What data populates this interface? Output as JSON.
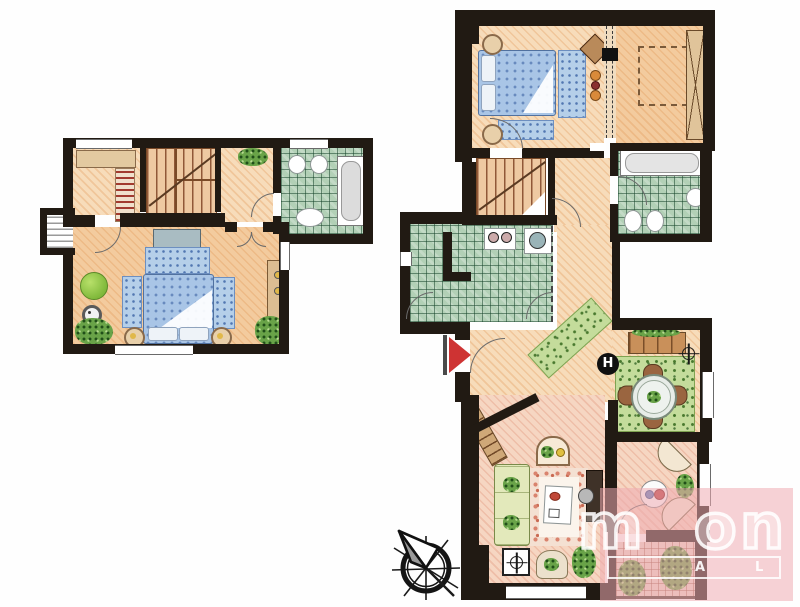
{
  "palette": {
    "wall_ink": "#211a13",
    "floor_peach": "#f7dcba",
    "floor_warm": "#f3cb9e",
    "floor_rose": "#f6d6c2",
    "tile_green": "#b2d0b6",
    "tile_green_line": "#1f4a30",
    "balcony_tile": "#ecd4c8",
    "bed_blue": "#a9c5e6",
    "rug_blue": "#b5cfe9",
    "rug_green": "#c4dc9b",
    "plant_green": "#69a348",
    "furniture_tan": "#e0c49a",
    "wood_brown": "#9a6540",
    "fixture_white": "#ffffff",
    "entrance_red": "#ce3333",
    "watermark_pink": "#eeacb2",
    "ink": "#1a1a1a"
  },
  "symbols": {
    "h_marker": "H"
  },
  "watermark": {
    "letters": [
      "m",
      "o",
      "n"
    ],
    "bar_letters": [
      "A",
      "L"
    ]
  },
  "icons": [
    "compass-rose-icon",
    "entrance-arrow-icon",
    "ceiling-light-icon",
    "floor-socket-icon",
    "h-marker-icon"
  ]
}
